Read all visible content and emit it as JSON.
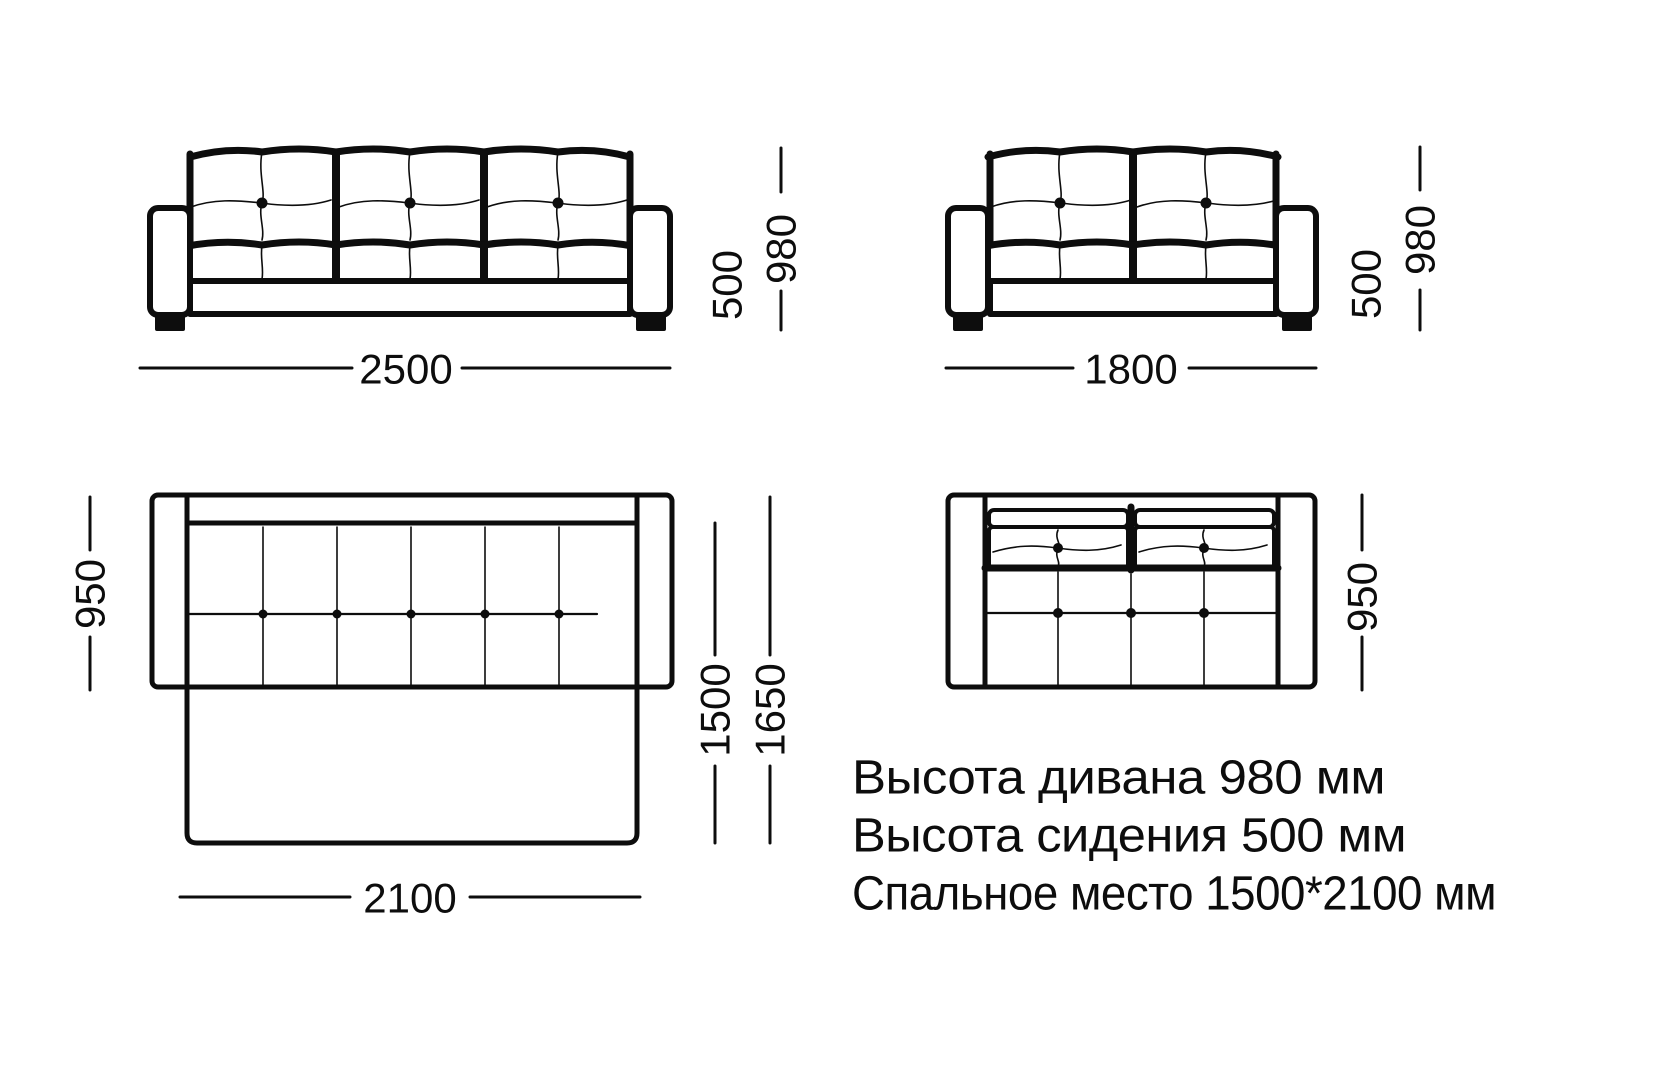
{
  "page": {
    "title": "sofa-dimensions-diagram",
    "colors": {
      "ink": "#0d0d0d",
      "background": "#ffffff"
    }
  },
  "views": {
    "front_three_seat": {
      "width_mm": "2500",
      "seat_height_mm": "500",
      "overall_height_mm": "980"
    },
    "front_two_seat": {
      "width_mm": "1800",
      "seat_height_mm": "500",
      "overall_height_mm": "980"
    },
    "top_sofa_bed_unfolded": {
      "depth_mm": "950",
      "bed_depth_mm": "1500",
      "overall_depth_mm": "1650",
      "bed_width_mm": "2100"
    },
    "top_two_seat": {
      "depth_mm": "950"
    }
  },
  "notes": {
    "sofa_height": "Высота дивана 980 мм",
    "seat_height": "Высота сидения 500 мм",
    "sleeping_area": "Спальное место 1500*2100 мм"
  }
}
